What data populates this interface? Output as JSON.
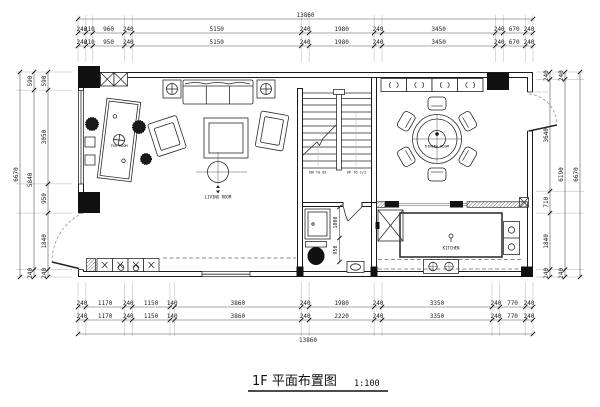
{
  "title": {
    "name": "1F 平面布置图",
    "scale": "1:100"
  },
  "colors": {
    "background": "#ffffff",
    "ink": "#1a1a1a",
    "dim_text": "#222222"
  },
  "dimensions": {
    "top_overall": "13860",
    "top_row1": [
      "240",
      "210",
      "960",
      "240",
      "5150",
      "240",
      "1980",
      "240",
      "3450",
      "240",
      "670",
      "240"
    ],
    "top_row2": [
      "240",
      "210",
      "950",
      "240",
      "5150",
      "240",
      "1980",
      "240",
      "3450",
      "240",
      "670",
      "240"
    ],
    "bottom_row1": [
      "240",
      "1170",
      "240",
      "1150",
      "140",
      "3860",
      "240",
      "1980",
      "240",
      "3350",
      "240",
      "770",
      "240"
    ],
    "bottom_row2": [
      "240",
      "1170",
      "240",
      "1150",
      "140",
      "3860",
      "240",
      "2220",
      "240",
      "3350",
      "240",
      "770",
      "240"
    ],
    "bottom_overall": "13860",
    "left_inner": [
      "590",
      "3050",
      "950",
      "1840",
      "240"
    ],
    "left_middle": [
      "590",
      "5840",
      "240"
    ],
    "left_overall": "6670",
    "right_inner": [
      "240",
      "3640",
      "710",
      "1840",
      "240"
    ],
    "right_middle": [
      "240",
      "6190",
      "240"
    ],
    "right_overall": "6670",
    "bath": [
      "1000",
      "950"
    ]
  },
  "rooms": {
    "tea_room": "TEA ROOM",
    "living_room": "LIVING ROOM",
    "dining_room": "DINING ROOM",
    "kitchen": "KITCHEN",
    "stairs_down": "DN TO B1",
    "stairs_up": "UP TO 1/2"
  }
}
